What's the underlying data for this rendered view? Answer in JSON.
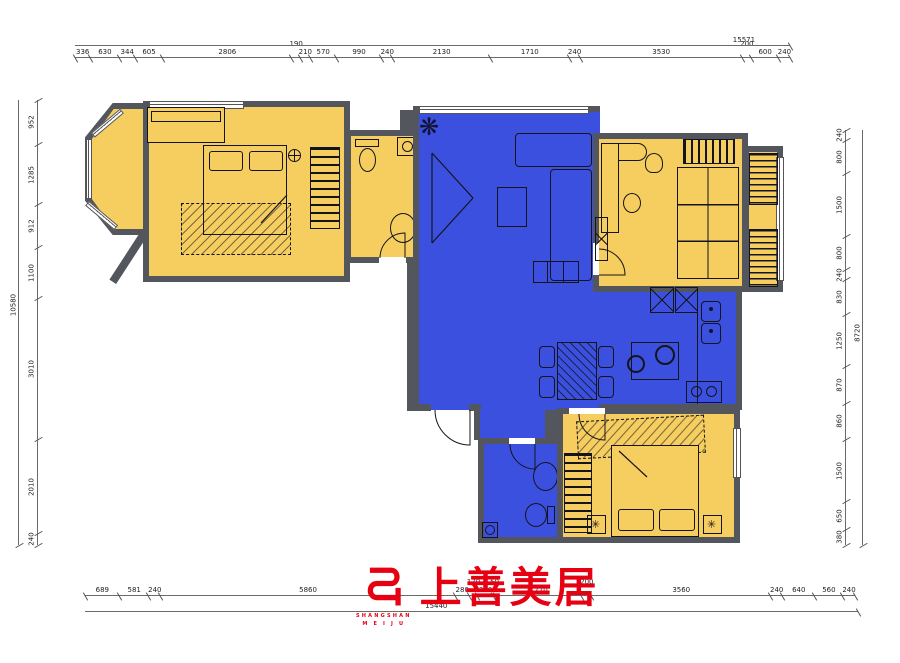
{
  "drawing": {
    "type": "residential floor plan"
  },
  "colors": {
    "room_yellow": "#f6cd5f",
    "room_blue": "#3c50df",
    "wall": "#54565e",
    "line": "#14141c",
    "logo_red": "#e60012",
    "background": "#ffffff"
  },
  "dimensions": {
    "top": {
      "total": "15571",
      "segments": [
        {
          "v": 336
        },
        {
          "v": 630
        },
        {
          "v": 344
        },
        {
          "v": 605
        },
        {
          "v": 2806
        },
        {
          "v": 190,
          "raised": true
        },
        {
          "v": 210
        },
        {
          "v": 570
        },
        {
          "v": 990
        },
        {
          "v": 240
        },
        {
          "v": 2130
        },
        {
          "v": 1710
        },
        {
          "v": 240
        },
        {
          "v": 3530
        },
        {
          "v": 200,
          "raised": true
        },
        {
          "v": 600
        },
        {
          "v": 240
        }
      ]
    },
    "bottom": {
      "total": "15440",
      "segments": [
        {
          "v": 689
        },
        {
          "v": 581
        },
        {
          "v": 240
        },
        {
          "v": 5860
        },
        {
          "v": 280
        },
        {
          "v": 170,
          "raised": true
        },
        {
          "v": 310
        },
        {
          "v": 50,
          "raised": true
        },
        {
          "v": 1710
        },
        {
          "v": 200,
          "raised": true
        },
        {
          "v": 3560
        },
        {
          "v": 240
        },
        {
          "v": 640
        },
        {
          "v": 560
        },
        {
          "v": 240
        }
      ]
    },
    "left": {
      "total": "10580",
      "segments": [
        {
          "v": 952
        },
        {
          "v": 1285
        },
        {
          "v": 912
        },
        {
          "v": 1100
        },
        {
          "v": 3010
        },
        {
          "v": 2010
        },
        {
          "v": 240
        }
      ]
    },
    "right": {
      "total": "8720",
      "segments": [
        {
          "v": 240
        },
        {
          "v": 800
        },
        {
          "v": 1500
        },
        {
          "v": 800
        },
        {
          "v": 240
        },
        {
          "v": 830
        },
        {
          "v": 1250
        },
        {
          "v": 870
        },
        {
          "v": 860
        },
        {
          "v": 1500
        },
        {
          "v": 650
        },
        {
          "v": 380
        }
      ]
    }
  },
  "logo": {
    "chinese": "上善美居",
    "latin_line1": "SHANGSHAN",
    "latin_line2": "M E I J U"
  },
  "glyphs": {
    "plant": "❋",
    "lamp": "✳"
  }
}
